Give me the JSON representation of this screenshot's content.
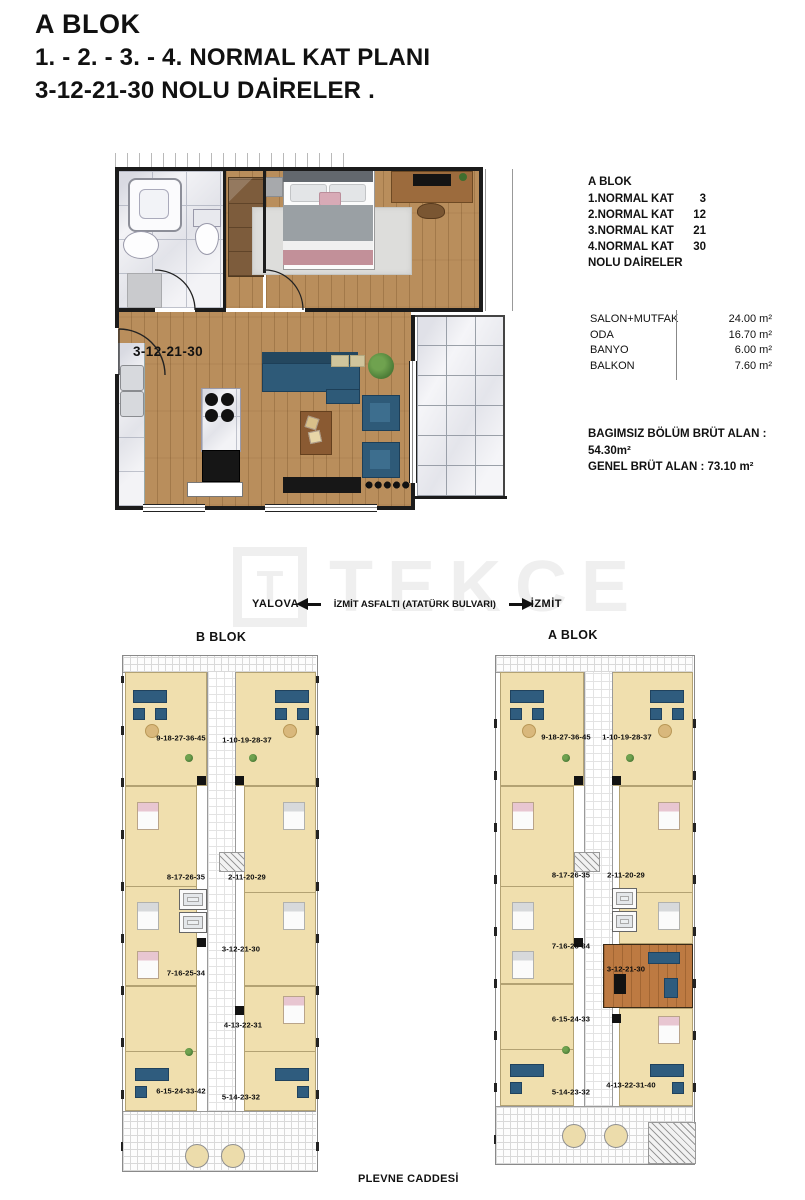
{
  "header": {
    "line1": "A BLOK",
    "line2": "1. - 2. - 3. - 4. NORMAL  KAT  PLANI",
    "line3": "3-12-21-30 NOLU DAİRELER ."
  },
  "unit_plan": {
    "label": "3-12-21-30"
  },
  "info_panel": {
    "block_title": "A BLOK",
    "floors": [
      {
        "label": "1.NORMAL KAT",
        "value": "3"
      },
      {
        "label": "2.NORMAL KAT",
        "value": "12"
      },
      {
        "label": "3.NORMAL KAT",
        "value": "21"
      },
      {
        "label": "4.NORMAL KAT",
        "value": "30"
      }
    ],
    "floors_suffix": "NOLU  DAİRELER",
    "rooms": [
      {
        "name": "SALON+MUTFAK",
        "area": "24.00 m²"
      },
      {
        "name": "ODA",
        "area": "16.70 m²"
      },
      {
        "name": "BANYO",
        "area": "6.00 m²"
      },
      {
        "name": "BALKON",
        "area": "7.60 m²"
      }
    ],
    "gross_line1": "BAGIMSIZ  BÖLÜM BRÜT ALAN : 54.30m²",
    "gross_line2": "GENEL BRÜT ALAN : 73.10 m²"
  },
  "watermark": {
    "logo_letter": "T",
    "text": "TEKCE"
  },
  "road": {
    "left_city": "YALOVA",
    "road_name": "İZMİT ASFALTI  (ATATÜRK  BULVARI)",
    "right_city": "İZMİT"
  },
  "site_plan": {
    "b_block": {
      "title": "B BLOK",
      "units": [
        "9-18-27-36-45",
        "1-10-19-28-37",
        "8-17-26-35",
        "2-11-20-29",
        "3-12-21-30",
        "7-16-25-34",
        "4-13-22-31",
        "6-15-24-33-42",
        "5-14-23-32"
      ]
    },
    "a_block": {
      "title": "A BLOK",
      "units": [
        "9-18-27-36-45",
        "1-10-19-28-37",
        "8-17-26-35",
        "2-11-20-29",
        "7-16-25-34",
        "3-12-21-30",
        "6-15-24-33",
        "5-14-23-32",
        "4-13-22-31-40"
      ]
    },
    "street": "PLEVNE CADDESİ"
  },
  "colors": {
    "wood_floor": "#b98e5c",
    "unit_cream": "#f0dfae",
    "highlight_unit": "#bd7a42",
    "sofa_blue": "#2e5a78",
    "text": "#111111"
  }
}
